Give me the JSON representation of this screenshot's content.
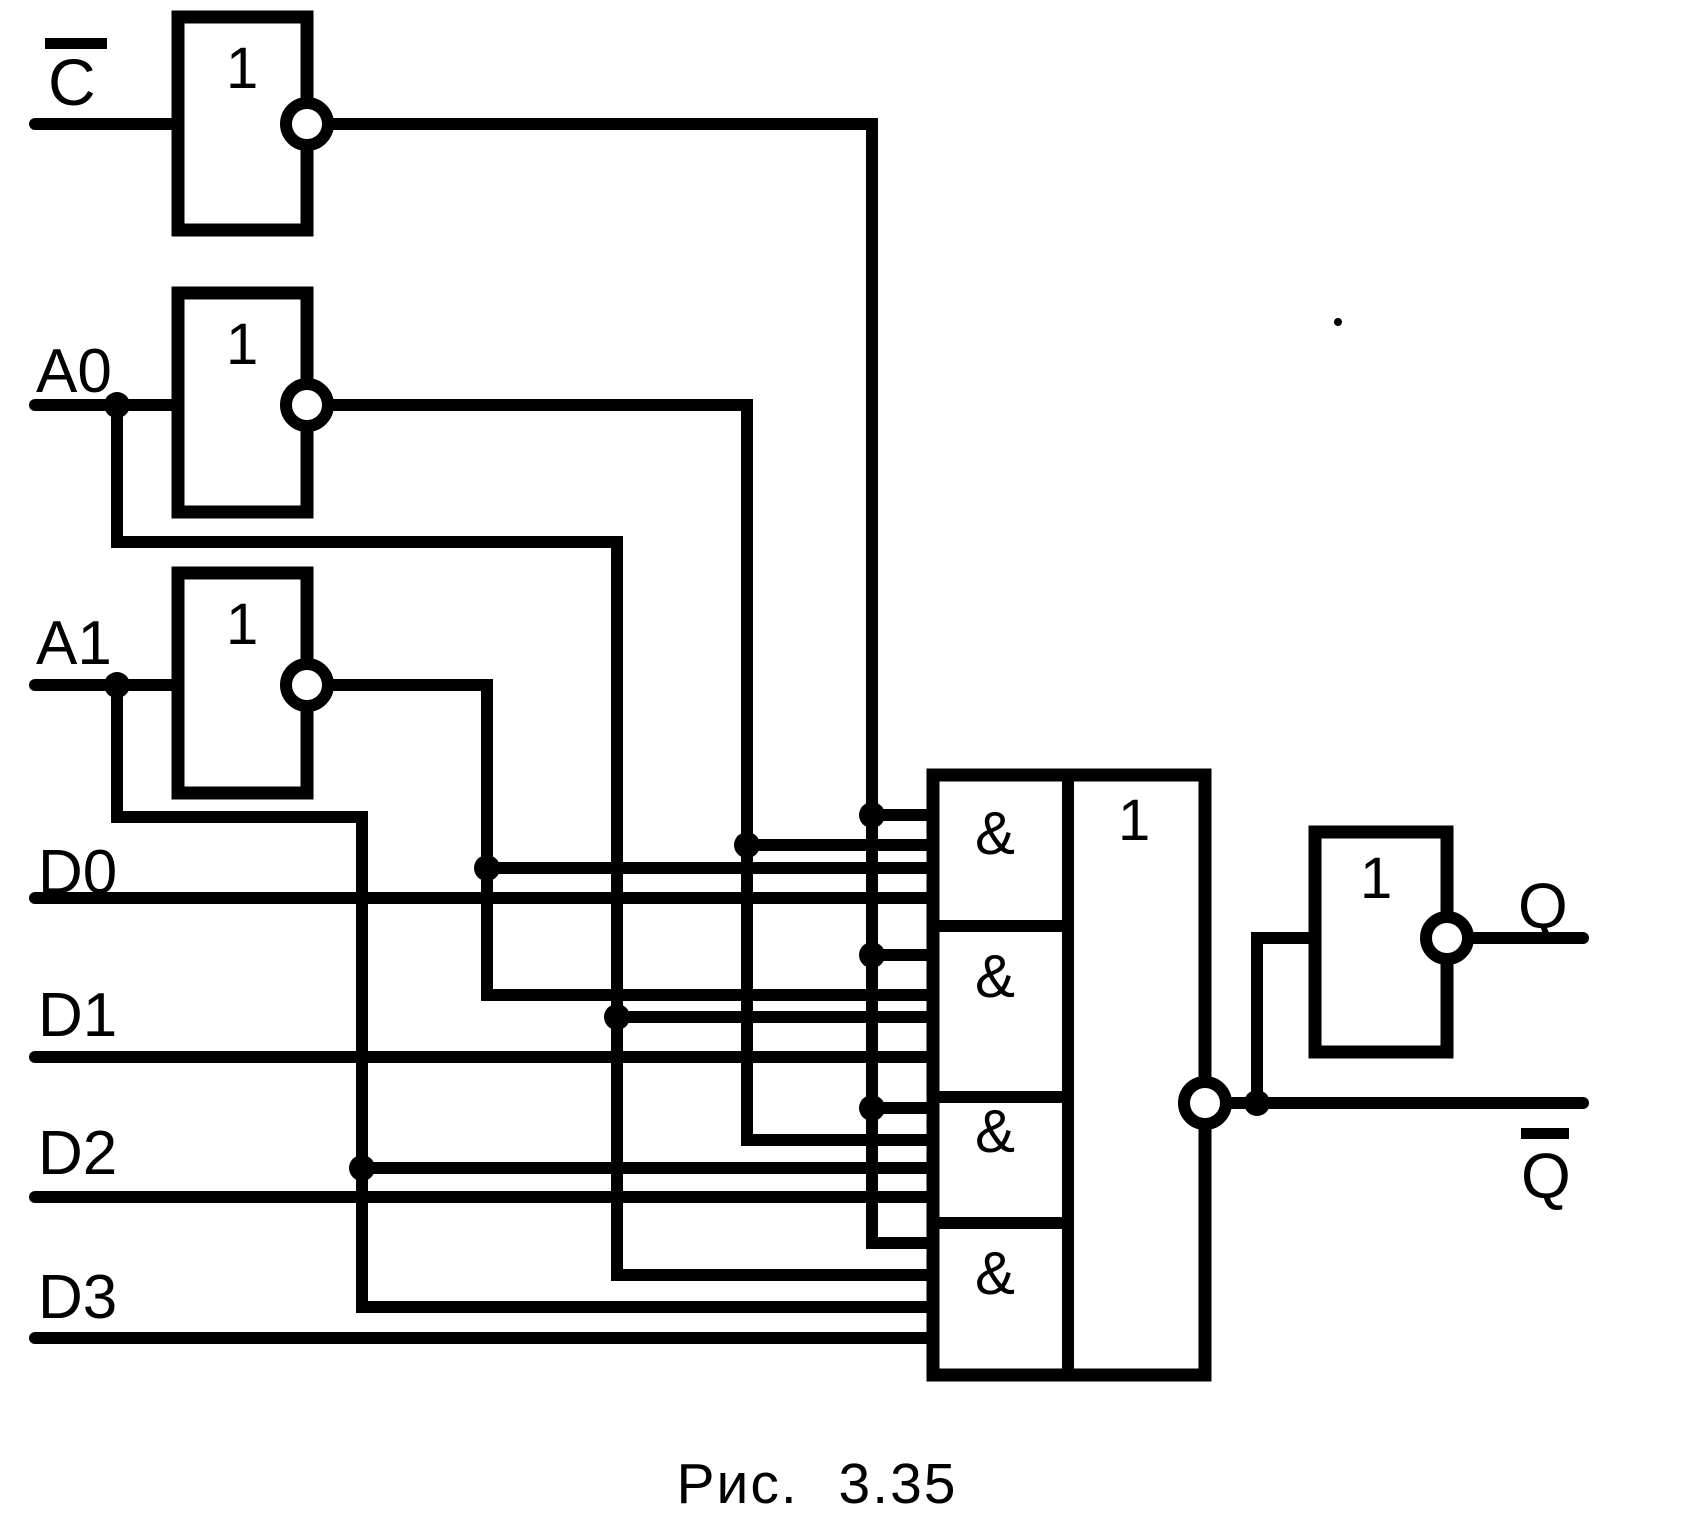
{
  "figure": {
    "caption": "Рис. 3.35",
    "type": "logic-circuit-diagram",
    "description": "Four-input multiplexer latch built from NOT gates, a 4x AND / OR-NOT block and an output inverter"
  },
  "colors": {
    "ink": "#000000",
    "paper": "#ffffff"
  },
  "labels": {
    "c_input": "C",
    "c_input_overline": true,
    "a0_input": "A0",
    "a1_input": "A1",
    "d0_input": "D0",
    "d1_input": "D1",
    "d2_input": "D2",
    "d3_input": "D3",
    "q_output": "Q",
    "q_bar_output": "Q",
    "q_bar_overline": true,
    "not_gate": "1",
    "or_gate": "1",
    "and_gate": "&"
  }
}
